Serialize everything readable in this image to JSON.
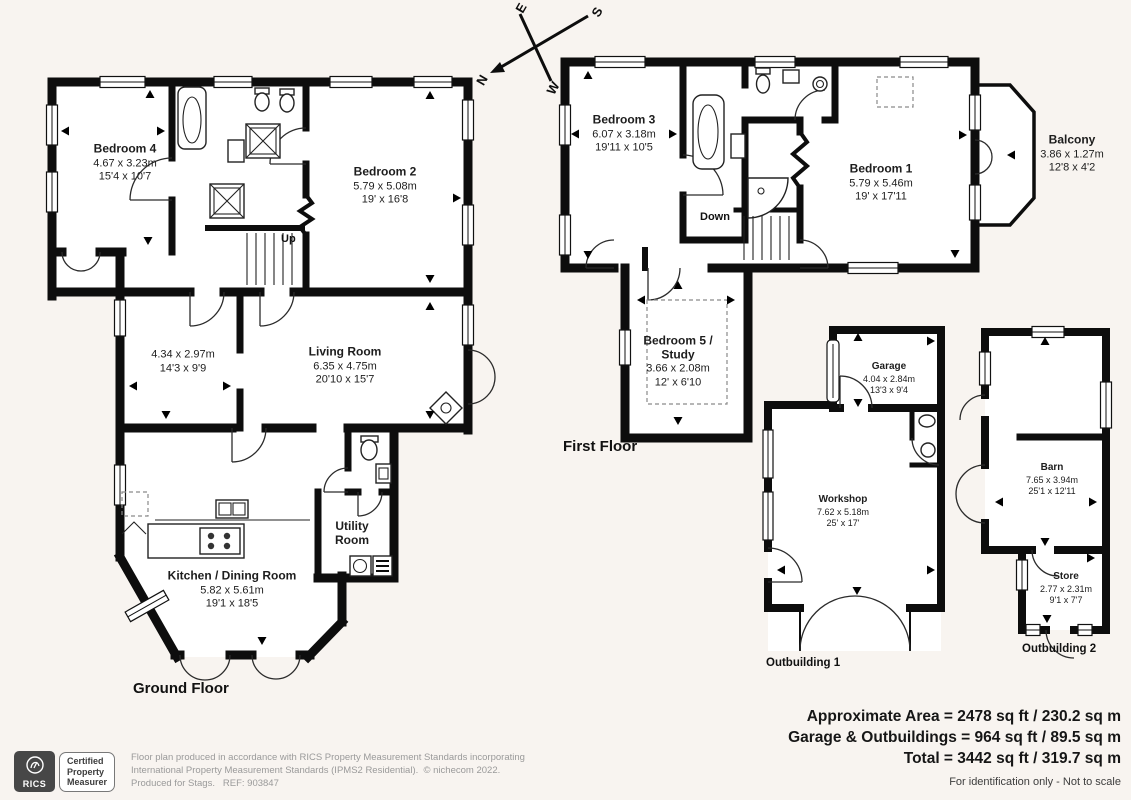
{
  "compass": {
    "n": "N",
    "e": "E",
    "s": "S",
    "w": "W"
  },
  "gf": {
    "title": "Ground Floor",
    "up": "Up",
    "bedroom4": {
      "name": "Bedroom 4",
      "m": "4.67 x 3.23m",
      "ft": "15'4 x 10'7"
    },
    "bedroom2": {
      "name": "Bedroom 2",
      "m": "5.79 x 5.08m",
      "ft": "19' x 16'8"
    },
    "room434": {
      "m": "4.34 x 2.97m",
      "ft": "14'3 x 9'9"
    },
    "living": {
      "name": "Living Room",
      "m": "6.35 x 4.75m",
      "ft": "20'10 x 15'7"
    },
    "kitchen": {
      "name": "Kitchen / Dining Room",
      "m": "5.82 x 5.61m",
      "ft": "19'1 x 18'5"
    },
    "utility": {
      "name": "Utility Room"
    }
  },
  "ff": {
    "title": "First Floor",
    "down": "Down",
    "bedroom3": {
      "name": "Bedroom 3",
      "m": "6.07 x 3.18m",
      "ft": "19'11 x 10'5"
    },
    "bedroom1": {
      "name": "Bedroom 1",
      "m": "5.79 x 5.46m",
      "ft": "19' x 17'11"
    },
    "balcony": {
      "name": "Balcony",
      "m": "3.86 x 1.27m",
      "ft": "12'8 x 4'2"
    },
    "bedroom5": {
      "name": "Bedroom 5 / Study",
      "m": "3.66 x 2.08m",
      "ft": "12' x 6'10"
    }
  },
  "ob1": {
    "title": "Outbuilding 1",
    "garage": {
      "name": "Garage",
      "m": "4.04 x 2.84m",
      "ft": "13'3 x 9'4"
    },
    "workshop": {
      "name": "Workshop",
      "m": "7.62 x 5.18m",
      "ft": "25' x 17'"
    }
  },
  "ob2": {
    "title": "Outbuilding 2",
    "barn": {
      "name": "Barn",
      "m": "7.65 x 3.94m",
      "ft": "25'1 x 12'11"
    },
    "store": {
      "name": "Store",
      "m": "2.77 x 2.31m",
      "ft": "9'1 x 7'7"
    }
  },
  "summary": {
    "line1": "Approximate Area = 2478 sq ft / 230.2 sq m",
    "line2": "Garage & Outbuildings = 964 sq ft / 89.5 sq m",
    "line3": "Total = 3442 sq ft / 319.7 sq m",
    "note": "For identification only - Not to scale"
  },
  "footer": {
    "rics": "RICS",
    "badge_line1": "Certified",
    "badge_line2": "Property",
    "badge_line3": "Measurer",
    "disc_line1": "Floor plan produced in accordance with RICS Property Measurement Standards incorporating",
    "disc_line2": "International Property Measurement Standards (IPMS2 Residential).  © nichecom 2022.",
    "disc_line3": "Produced for Stags.   REF: 903847"
  }
}
